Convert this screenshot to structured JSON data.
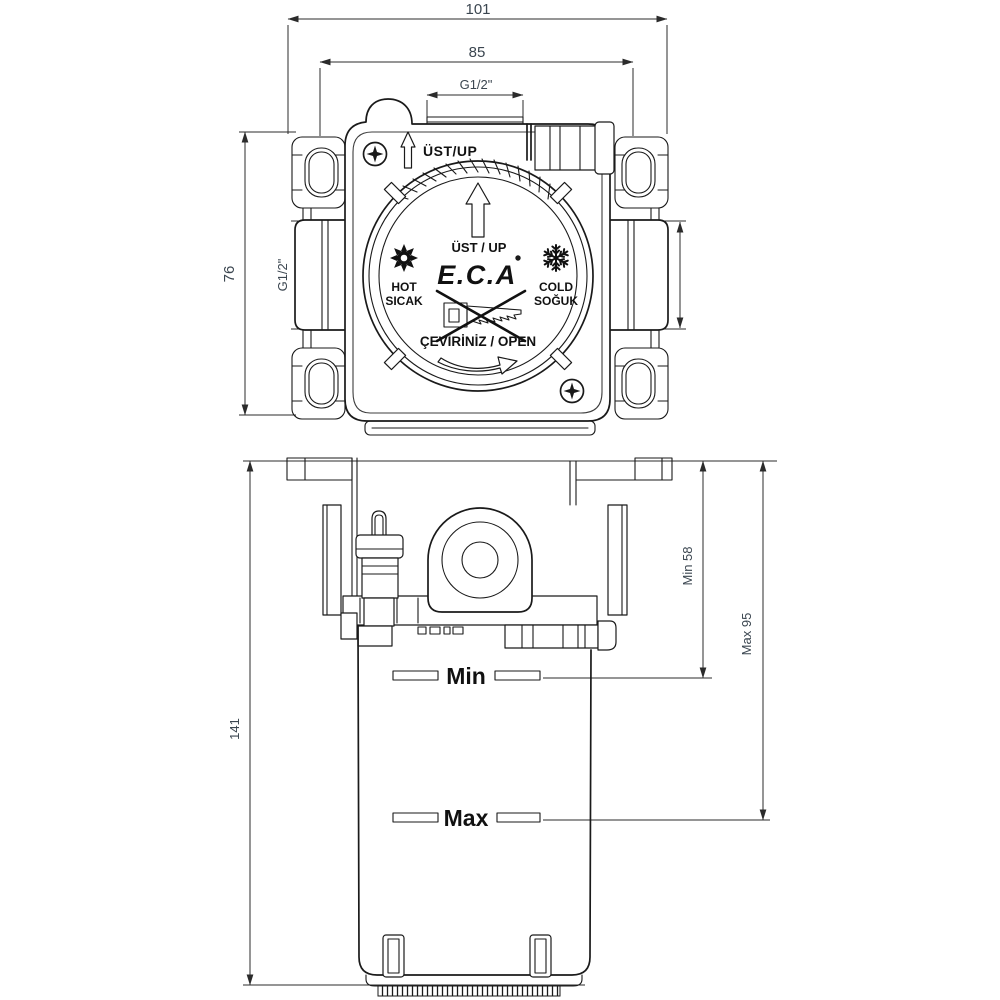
{
  "top_view": {
    "dim_overall_width": "101",
    "dim_mount_spacing": "85",
    "dim_top_port": "G1/2\"",
    "dim_mount_height": "76",
    "dim_left_port": "G1/2\"",
    "dim_right_port": "G1/2\"",
    "label_up_outer": "ÜST/UP",
    "label_up_inner": "ÜST / UP",
    "brand": "E.C.A",
    "label_hot_en": "HOT",
    "label_hot_tr": "SICAK",
    "label_cold_en": "COLD",
    "label_cold_tr": "SOĞUK",
    "label_open": "ÇEVİRİNİZ / OPEN"
  },
  "front_view": {
    "dim_total_height": "141",
    "dim_min": "Min 58",
    "dim_max": "Max 95",
    "label_min": "Min",
    "label_max": "Max"
  },
  "colors": {
    "line": "#1a1a1a",
    "dim_text": "#3b4650",
    "background": "#ffffff"
  }
}
